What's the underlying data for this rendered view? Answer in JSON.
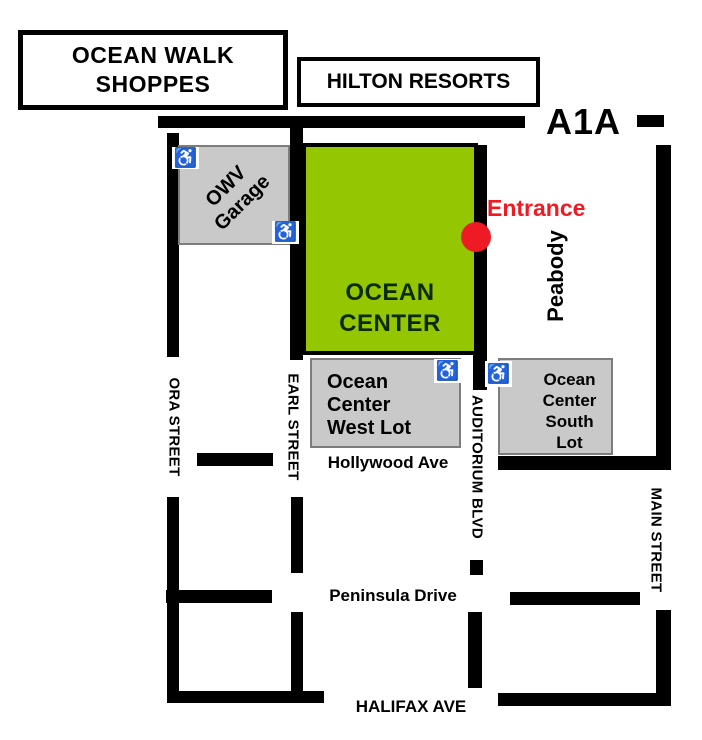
{
  "colors": {
    "green": "#94c602",
    "lot-gray": "#c9c9c9",
    "road": "#000000",
    "accent-red": "#ee1b24",
    "ink": "#000000",
    "center-ink": "#0d2b00"
  },
  "buildings": {
    "ocean_walk": {
      "lines": [
        "OCEAN WALK",
        "SHOPPES"
      ]
    },
    "hilton": {
      "label": "HILTON RESORTS"
    },
    "owv_garage": {
      "lines": [
        "OWV",
        "Garage"
      ]
    },
    "ocean_center": {
      "lines": [
        "OCEAN",
        "CENTER"
      ]
    },
    "west_lot": {
      "lines": [
        "Ocean",
        "Center",
        "West Lot"
      ]
    },
    "south_lot": {
      "lines": [
        "Ocean",
        "Center",
        "South",
        "Lot"
      ]
    }
  },
  "streets": {
    "a1a": "A1A",
    "peabody": "Peabody",
    "ora": "ORA STREET",
    "earl": "EARL STREET",
    "auditorium": "AUDITORIUM BLVD",
    "main": "MAIN STREET",
    "hollywood": "Hollywood Ave",
    "peninsula": "Peninsula Drive",
    "halifax": "HALIFAX AVE"
  },
  "markers": {
    "entrance_label": "Entrance"
  },
  "icons": {
    "wheelchair_glyph": "♿"
  }
}
